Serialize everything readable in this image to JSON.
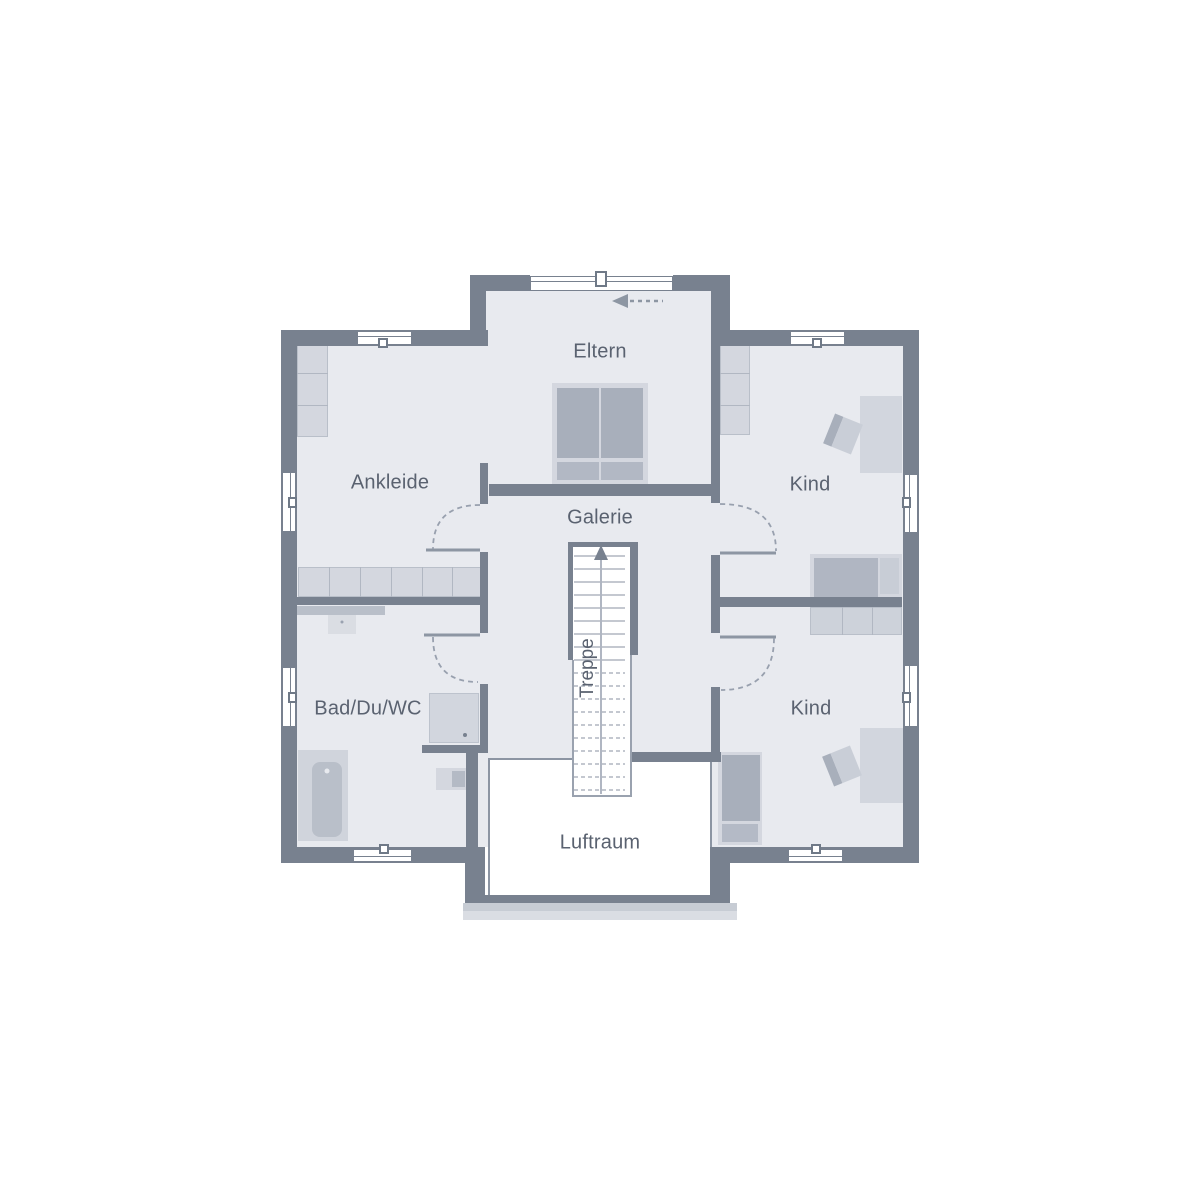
{
  "floor_plan": {
    "labels": {
      "eltern": "Eltern",
      "ankleide": "Ankleide",
      "kind_top": "Kind",
      "kind_bottom": "Kind",
      "galerie": "Galerie",
      "treppe": "Treppe",
      "bad": "Bad/Du/WC",
      "luftraum": "Luftraum"
    },
    "colors": {
      "wall": "#78818f",
      "floor": "#e8eaef",
      "void": "#ffffff",
      "furniture_light": "#d4d7df",
      "furniture_medium": "#c6cbd4",
      "furniture_dark": "#a8afbb",
      "label_text": "#5a6270"
    }
  }
}
